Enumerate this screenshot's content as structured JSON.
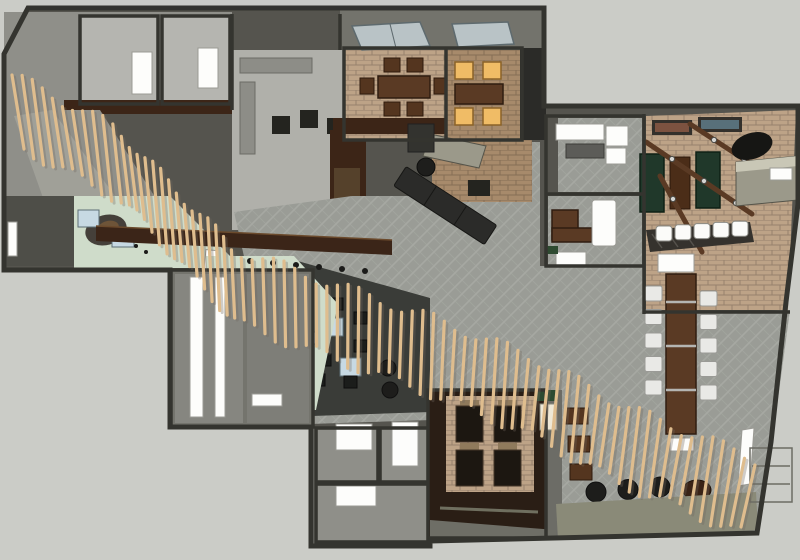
{
  "scene": {
    "type": "3d-floorplan-top-view",
    "description": "SketchUp-style rendered interior plan of a hospitality space with a diagonal wood-slat ceiling ribbon",
    "canvas": {
      "width": 800,
      "height": 560
    }
  },
  "palette": {
    "bg": "#cbccc7",
    "wall_fill": "#55544e",
    "wall_line": "#34342f",
    "roof": "#8f8f89",
    "roof_band": "#73736c",
    "panel": "#b5b5b0",
    "floor_light": "#b0b0aa",
    "carpet_base": "#9a9c96",
    "carpet_hatch": "#a6a8a2",
    "brick": "#bda387",
    "brick_dark": "#a78a6b",
    "wood": "#5a3a24",
    "wood_dark": "#3c2517",
    "slat": "#dfbd8e",
    "slat_shadow": "#6f675c",
    "mint": "#cfdcca",
    "table_green": "#20382a",
    "amber": "#f0bc66",
    "white": "#fdfdfb",
    "taupe": "#9b998a",
    "bench": "#8a8a78",
    "glass_blue": "#b9c3c6",
    "table_blue": "#c7d9e3",
    "art_teal": "#2f555e",
    "art_orange": "#c8793f",
    "lounge_floor": "#3a3c38"
  },
  "areas": [
    {
      "name": "entry-reception",
      "floor": "mint",
      "features": [
        "curved-desk",
        "blue-side-tables",
        "white-bench"
      ]
    },
    {
      "name": "kitchen-boh",
      "floor": "light-gray",
      "features": [
        "counters",
        "prep-tables",
        "front-bar"
      ]
    },
    {
      "name": "private-dining-a",
      "floor": "brick",
      "seats": 6,
      "features": [
        "skylight",
        "banquette"
      ]
    },
    {
      "name": "private-dining-b",
      "floor": "brick",
      "seats": 4,
      "features": [
        "skylight",
        "lit-amber-chairs"
      ]
    },
    {
      "name": "meeting-room-upper",
      "floor": "carpet",
      "features": [
        "white-l-sofa",
        "low-table"
      ]
    },
    {
      "name": "meeting-room-lower",
      "floor": "carpet",
      "features": [
        "desk",
        "white-cabinet",
        "bench"
      ]
    },
    {
      "name": "games-room",
      "floor": "brick",
      "game_tables": 3,
      "bar_stools": 5,
      "features": [
        "framed-art",
        "pendant-rails",
        "drum-light",
        "window-ledge"
      ]
    },
    {
      "name": "communal-dining",
      "floor": "carpet",
      "table_seats": 10,
      "features": [
        "long-wood-table",
        "sideboard"
      ]
    },
    {
      "name": "lounge",
      "floor": "dark",
      "stools": 8,
      "tables": 2,
      "poufs": 2
    },
    {
      "name": "gallery-corridor",
      "floor": "mint",
      "features": [
        "art-feature-wall",
        "stone-sculpture",
        "white-side-tables"
      ]
    },
    {
      "name": "restroom-wing",
      "floor": "gray",
      "features": [
        "white-door-panels"
      ]
    },
    {
      "name": "service-wing",
      "floor": "gray",
      "rooms": 3
    },
    {
      "name": "booth-dining",
      "floor": "brick",
      "booths": 4,
      "features": [
        "host-stand",
        "brown-chairs"
      ]
    },
    {
      "name": "main-dining",
      "floor": "carpet",
      "features": [
        "diagonal-sofa",
        "floor-poufs",
        "perimeter-bench",
        "slat-ceiling-ribbon"
      ]
    }
  ],
  "furniture": {
    "slat_count": 76,
    "communal_chairs_per_side": 5,
    "bar_stool_count": 5,
    "booth_count": 4,
    "amber_chair_count": 4,
    "pouf_count": 3,
    "kitchen_stool_count": 6,
    "lounge_stool_count": 8
  }
}
